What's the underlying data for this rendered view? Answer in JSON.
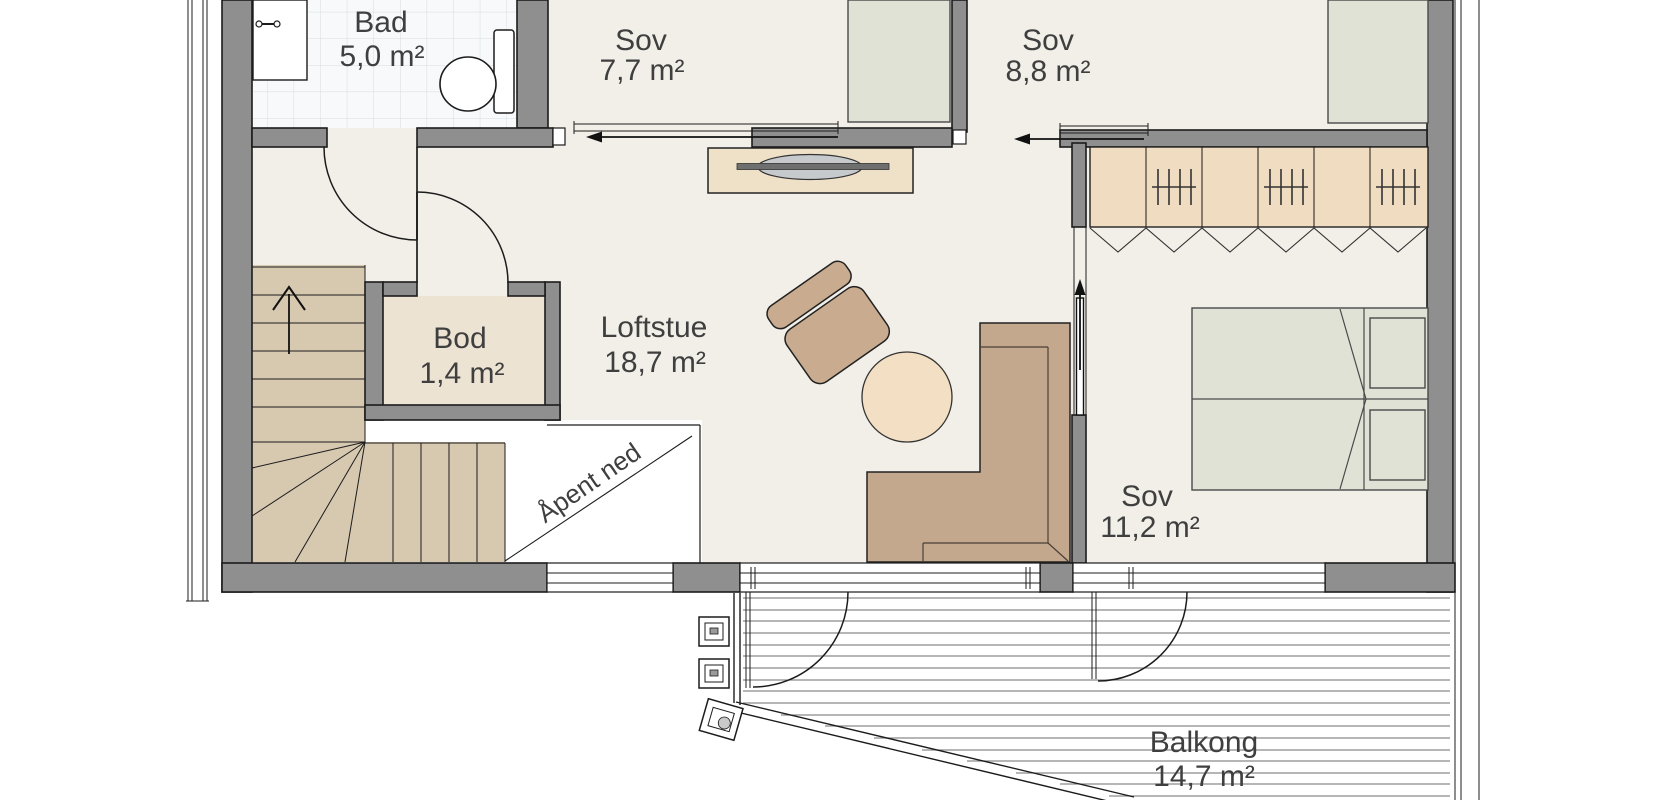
{
  "plan": {
    "type": "floor-plan",
    "language": "Norwegian"
  },
  "rooms": {
    "bad": {
      "name": "Bad",
      "area": "5,0 m²"
    },
    "sov1": {
      "name": "Sov",
      "area": "7,7 m²"
    },
    "sov2": {
      "name": "Sov",
      "area": "8,8 m²"
    },
    "bod": {
      "name": "Bod",
      "area": "1,4 m²"
    },
    "loftstue": {
      "name": "Loftstue",
      "area": "18,7 m²"
    },
    "sov3": {
      "name": "Sov",
      "area": "11,2 m²"
    },
    "balkong": {
      "name": "Balkong",
      "area": "14,7 m²"
    }
  },
  "annotations": {
    "open_below": "Åpent ned"
  },
  "colors": {
    "wall": "#8f8f8f",
    "floor": "#f2efe8",
    "tile": "#f7f9fa",
    "tile_line": "#d9dde1",
    "stair": "#d7c8b0",
    "storage_floor": "#ece3d3",
    "sideboard": "#efe1c8",
    "wardrobe": "#f0dcc1",
    "seat": "#c9ac90",
    "sofa": "#c3a88e",
    "table": "#f3e0c4",
    "bed": "#dfe2d5",
    "tv": "#c7cacd",
    "tv_bar": "#6f6f6f",
    "deck_line": "#8a8a8a",
    "label": "#3f3f3f"
  }
}
